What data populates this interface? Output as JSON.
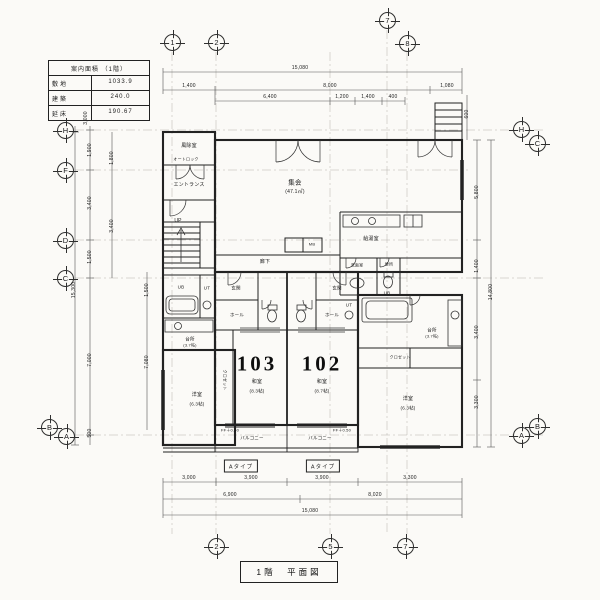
{
  "drawing": {
    "kind": "architectural floor plan (Japanese)",
    "bg_color": "#fbfaf7",
    "line_color": "#2b2b2b"
  },
  "area_table": {
    "title": "案内面積 （1階）",
    "rows": [
      {
        "label": "敷地",
        "value": "1033.9"
      },
      {
        "label": "建築",
        "value": "240.0"
      },
      {
        "label": "延床",
        "value": "190.67"
      }
    ]
  },
  "title_block": {
    "label": "1階　平面図"
  },
  "grid": {
    "top": [
      "1",
      "2",
      "7",
      "8"
    ],
    "bottom": [
      "2",
      "5",
      "7"
    ],
    "left": [
      "H",
      "F",
      "D",
      "C",
      "B",
      "A"
    ],
    "right": [
      "H",
      "C",
      "B",
      "A"
    ]
  },
  "dims": {
    "top": [
      "15,080",
      "1,400",
      "8,000",
      "1,080",
      "6,400",
      "1,200",
      "1,400",
      "400"
    ],
    "bottom": [
      "3,000",
      "3,900",
      "3,900",
      "3,300",
      "6,900",
      "8,020",
      "15,080"
    ],
    "left": [
      "3,000",
      "1,900",
      "3,400",
      "1,500",
      "7,000",
      "500",
      "15,300",
      "1,800",
      "3,400",
      "1,500",
      "7,080"
    ],
    "right": [
      "600",
      "5,800",
      "1,400",
      "3,400",
      "3,300",
      "14,800"
    ]
  },
  "rooms": {
    "windbreak": "風除室",
    "autolock": "オートロック",
    "entrance": "エントランス",
    "up": "UP",
    "meeting_room": "集会",
    "meeting_room_area": "(47.1㎡)",
    "kitchenette": "給湯室",
    "washroom": "洗面室",
    "toilet": "便所",
    "corridor": "廊下",
    "mb": "MB",
    "genkan": "玄関",
    "hall": "ホール",
    "ut": "UT",
    "ub": "UB",
    "kitchen": "台所",
    "kitchen_size": "(3.7帖)",
    "closet": "クロゼット",
    "western_room": "洋室",
    "western_room_size": "(6.3帖)",
    "balcony": "バルコニー",
    "floor_level": "FF＋0.50",
    "type_a": "Aタイプ"
  },
  "units": [
    {
      "number": "103",
      "room": "和室",
      "size": "(8.3帖)"
    },
    {
      "number": "102",
      "room": "和室",
      "size": "(8.7帖)"
    }
  ]
}
